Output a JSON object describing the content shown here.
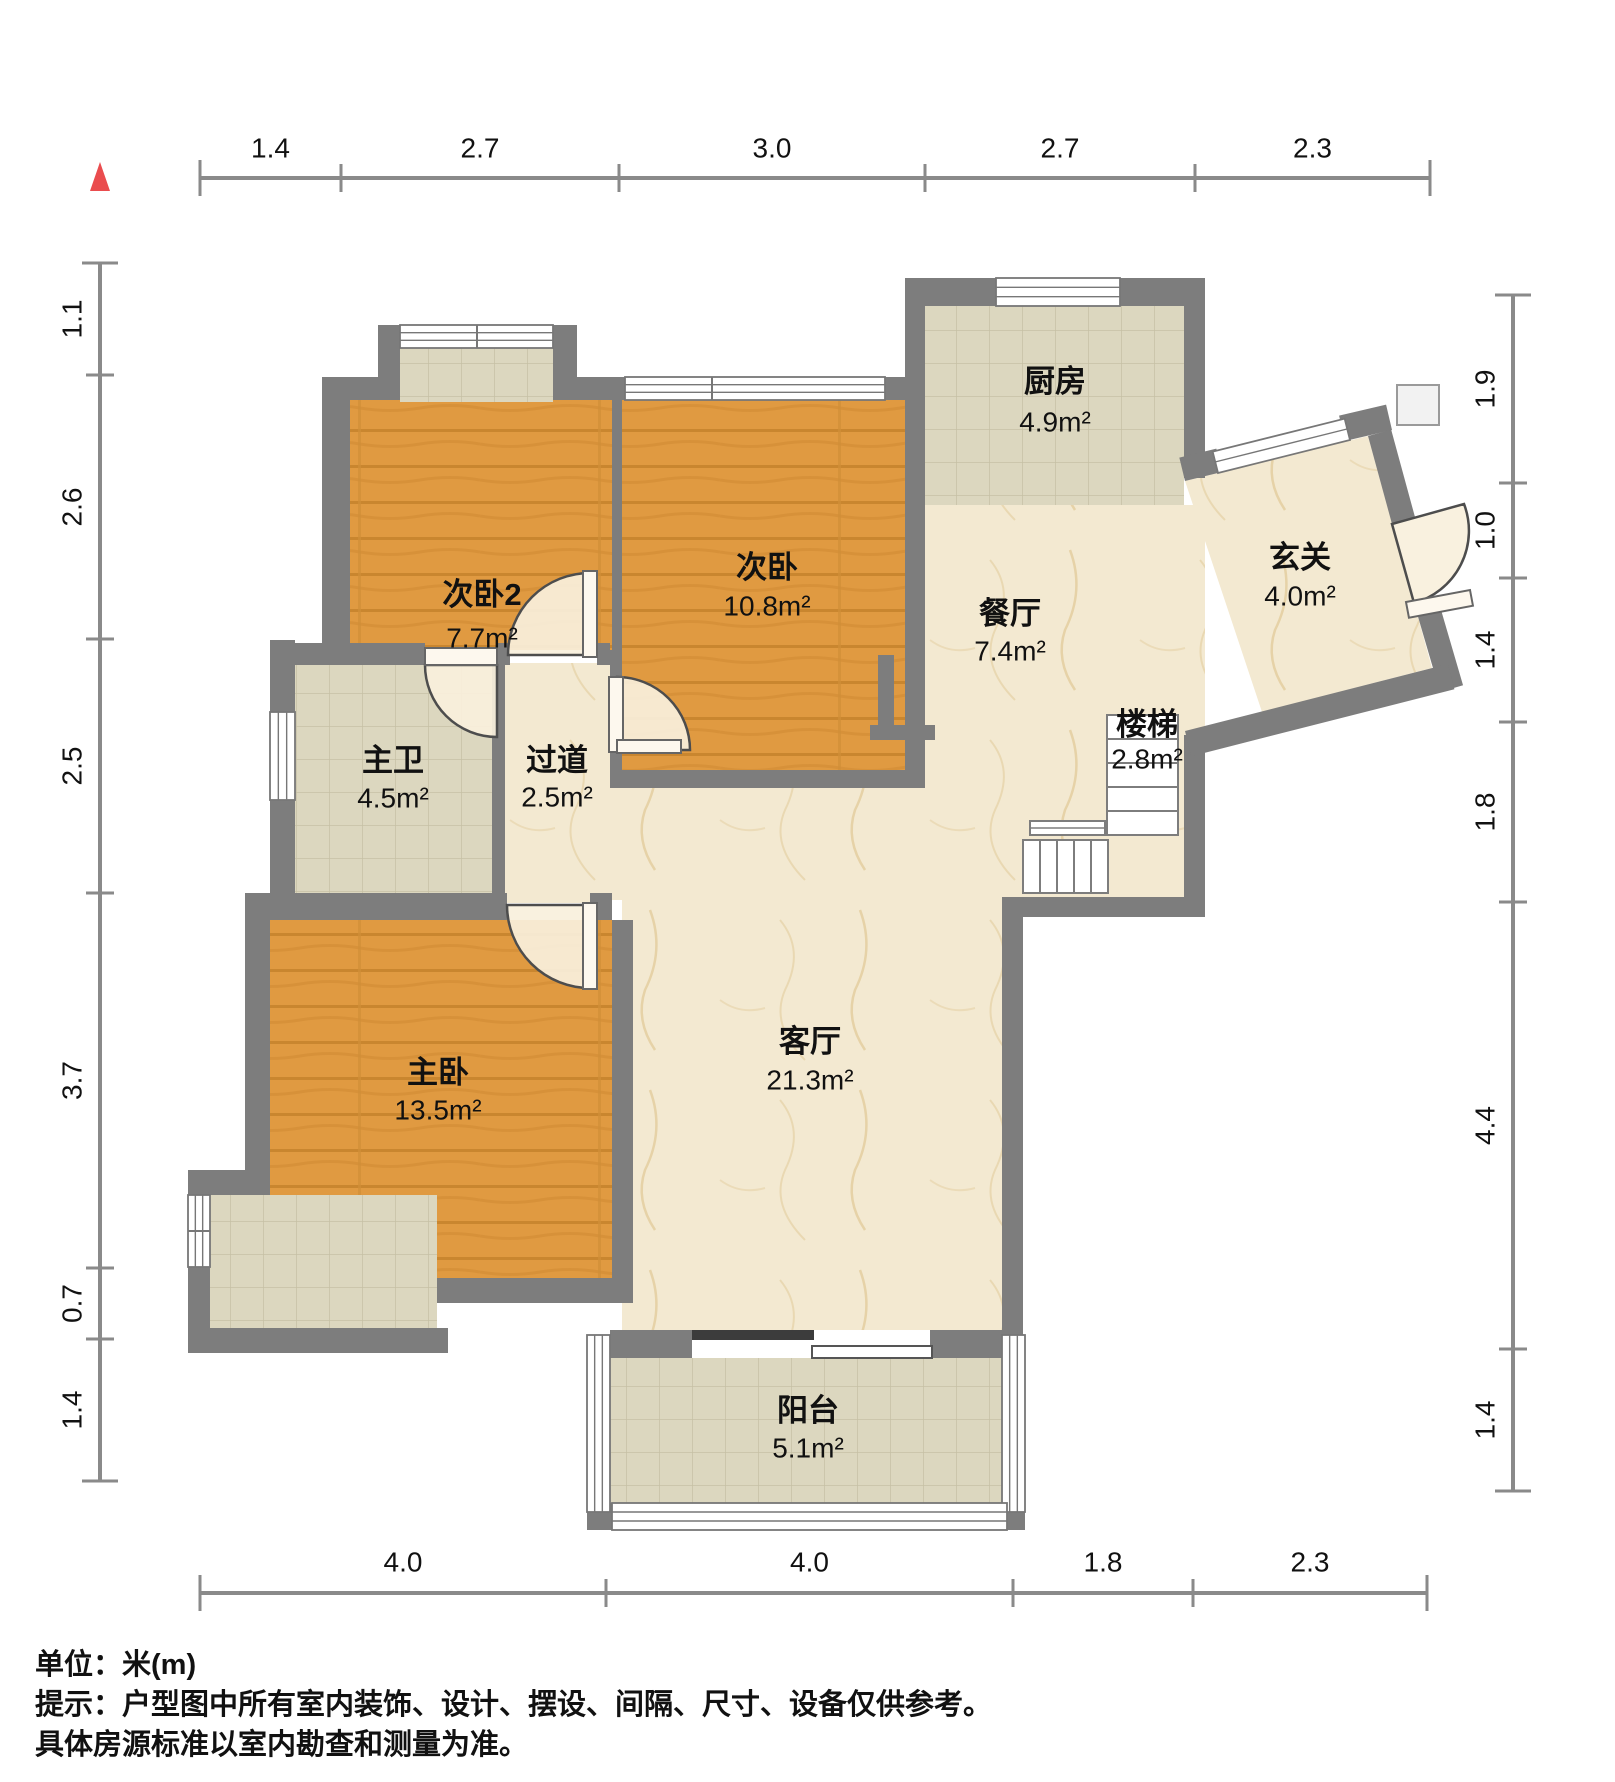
{
  "title": "户型图",
  "north_indicator": {
    "name": "north-arrow",
    "color": "#ea4c4e"
  },
  "rooms": [
    {
      "id": "ciwo2",
      "name": "次卧2",
      "area": "7.7m²"
    },
    {
      "id": "ciwo",
      "name": "次卧",
      "area": "10.8m²"
    },
    {
      "id": "chufang",
      "name": "厨房",
      "area": "4.9m²"
    },
    {
      "id": "xuanguan",
      "name": "玄关",
      "area": "4.0m²"
    },
    {
      "id": "canting",
      "name": "餐厅",
      "area": "7.4m²"
    },
    {
      "id": "louti",
      "name": "楼梯",
      "area": "2.8m²"
    },
    {
      "id": "zhuwei",
      "name": "主卫",
      "area": "4.5m²"
    },
    {
      "id": "guodao",
      "name": "过道",
      "area": "2.5m²"
    },
    {
      "id": "zhuwo",
      "name": "主卧",
      "area": "13.5m²"
    },
    {
      "id": "keting",
      "name": "客厅",
      "area": "21.3m²"
    },
    {
      "id": "yangtai",
      "name": "阳台",
      "area": "5.1m²"
    }
  ],
  "dimensions": {
    "top": [
      "1.4",
      "2.7",
      "3.0",
      "2.7",
      "2.3"
    ],
    "bottom": [
      "4.0",
      "4.0",
      "1.8",
      "2.3"
    ],
    "left": [
      "1.1",
      "2.6",
      "2.5",
      "3.7",
      "0.7",
      "1.4"
    ],
    "right": [
      "1.9",
      "1.0",
      "1.4",
      "1.8",
      "4.4",
      "1.4"
    ]
  },
  "notes": {
    "unit": "单位：米(m)",
    "tip1": "提示：户型图中所有室内装饰、设计、摆设、间隔、尺寸、设备仅供参考。",
    "tip2": "具体房源标准以室内勘查和测量为准。"
  },
  "palette": {
    "wall": "#7d7d7d",
    "wood": "#e09a41",
    "tile": "#dcd7bf",
    "marble": "#f3e9d1",
    "dim_line": "#8a8a8a",
    "text": "#111111",
    "door_fill": "#f8f0dc",
    "north": "#ea4c4e"
  }
}
